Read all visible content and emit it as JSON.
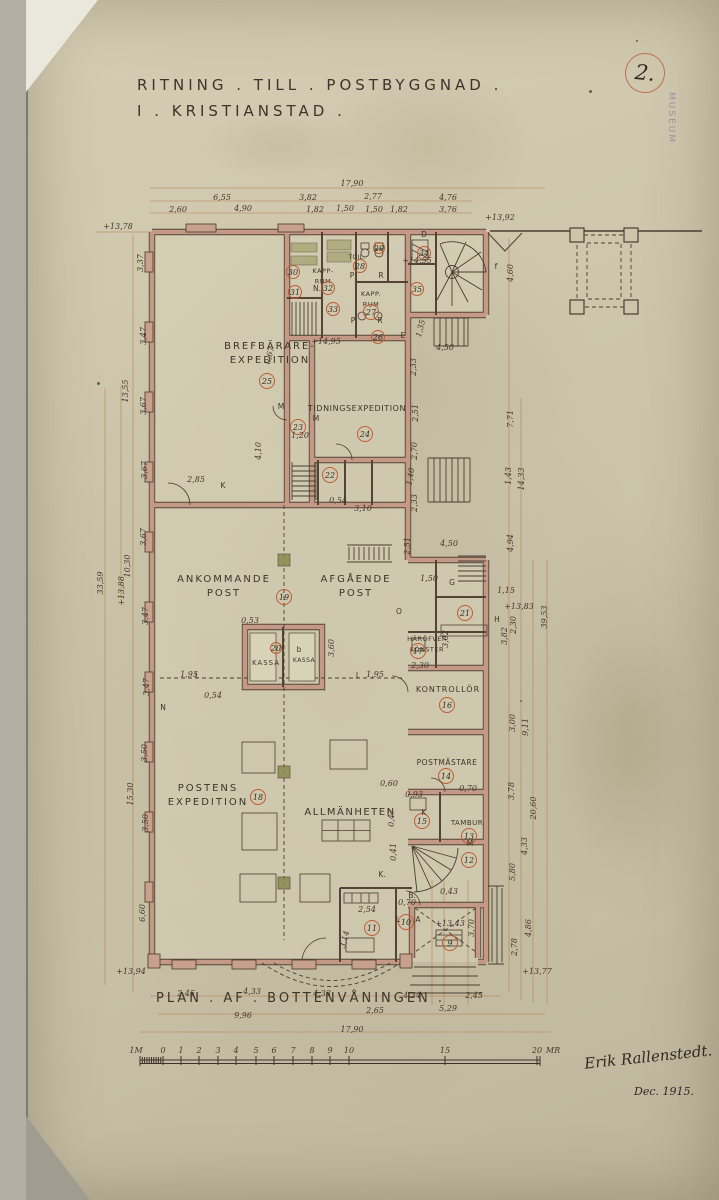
{
  "sheet": {
    "number": "2.",
    "stamp": "MUSEUM",
    "title_line1": "RITNING . TILL . POSTBYGGNAD .",
    "title_line2": "I . KRISTIANSTAD .",
    "caption": "PLAN . AF . BOTTENVÅNINGEN .",
    "signature": "Erik Rallenstedt.",
    "date": "Dec. 1915."
  },
  "colors": {
    "paper": "#ccc5ab",
    "ink": "#46362a",
    "wall_fill": "#c49a87",
    "wall_edge": "#544437",
    "dimension_line": "#b4703d",
    "number_circle": "#bf5b33",
    "column_green": "#8a8a50",
    "stamp_purple": "#8b7fa6"
  },
  "room_labels": [
    {
      "lines": [
        "BREFBÄRARE-",
        "EXPEDITION"
      ],
      "x": 270,
      "y": 349,
      "s": 10,
      "ls": 2
    },
    {
      "lines": [
        "TIDNINGSEXPEDITION"
      ],
      "x": 357,
      "y": 411,
      "s": 8,
      "ls": 0.6
    },
    {
      "lines": [
        "ANKOMMANDE",
        "POST"
      ],
      "x": 224,
      "y": 582,
      "s": 10,
      "ls": 2
    },
    {
      "lines": [
        "AFGÅENDE",
        "POST"
      ],
      "x": 356,
      "y": 582,
      "s": 10,
      "ls": 2
    },
    {
      "lines": [
        "KASSA"
      ],
      "x": 266,
      "y": 665,
      "s": 7,
      "ls": 1
    },
    {
      "lines": [
        "KASSA"
      ],
      "x": 304,
      "y": 662,
      "s": 6,
      "ls": 0.5
    },
    {
      "lines": [
        "HÄRÖFVER",
        "FÖNSTER"
      ],
      "x": 427,
      "y": 641,
      "s": 6.5,
      "ls": 0.5
    },
    {
      "lines": [
        "KONTROLLÖR"
      ],
      "x": 448,
      "y": 692,
      "s": 8,
      "ls": 1
    },
    {
      "lines": [
        "POSTMÄSTARE"
      ],
      "x": 447,
      "y": 765,
      "s": 7.5,
      "ls": 0.5
    },
    {
      "lines": [
        "POSTENS",
        "EXPEDITION"
      ],
      "x": 208,
      "y": 791,
      "s": 10,
      "ls": 2
    },
    {
      "lines": [
        "ALLMÄNHETEN"
      ],
      "x": 350,
      "y": 815,
      "s": 10,
      "ls": 1.5
    },
    {
      "lines": [
        "TAMBUR"
      ],
      "x": 467,
      "y": 825,
      "s": 7,
      "ls": 0.5
    },
    {
      "lines": [
        "KAPP-",
        "RUM"
      ],
      "x": 323,
      "y": 273,
      "s": 6.5,
      "ls": 0.5
    },
    {
      "lines": [
        "KAPP.",
        "RUM"
      ],
      "x": 371,
      "y": 296,
      "s": 6.5,
      "ls": 0.5
    },
    {
      "lines": [
        "TOIL."
      ],
      "x": 357,
      "y": 259,
      "s": 6,
      "ls": 0.3
    }
  ],
  "room_numbers": [
    {
      "n": "9",
      "x": 450,
      "y": 943
    },
    {
      "n": "10",
      "x": 406,
      "y": 922
    },
    {
      "n": "11",
      "x": 372,
      "y": 928
    },
    {
      "n": "12",
      "x": 469,
      "y": 860
    },
    {
      "n": "13",
      "x": 469,
      "y": 836
    },
    {
      "n": "14",
      "x": 446,
      "y": 776
    },
    {
      "n": "15",
      "x": 422,
      "y": 821
    },
    {
      "n": "16",
      "x": 447,
      "y": 705
    },
    {
      "n": "17",
      "x": 418,
      "y": 651
    },
    {
      "n": "18",
      "x": 258,
      "y": 797
    },
    {
      "n": "19",
      "x": 284,
      "y": 597
    },
    {
      "n": "20",
      "x": 276,
      "y": 648,
      "r": 5.5
    },
    {
      "n": "21",
      "x": 465,
      "y": 613
    },
    {
      "n": "22",
      "x": 330,
      "y": 475
    },
    {
      "n": "23",
      "x": 298,
      "y": 427
    },
    {
      "n": "24",
      "x": 365,
      "y": 434
    },
    {
      "n": "25",
      "x": 267,
      "y": 381
    },
    {
      "n": "26",
      "x": 378,
      "y": 337,
      "r": 6.5
    },
    {
      "n": "27",
      "x": 371,
      "y": 312
    },
    {
      "n": "28",
      "x": 360,
      "y": 266,
      "r": 6.5
    },
    {
      "n": "29",
      "x": 379,
      "y": 248,
      "r": 5.5
    },
    {
      "n": "30",
      "x": 293,
      "y": 272,
      "r": 6.5
    },
    {
      "n": "31",
      "x": 295,
      "y": 292,
      "r": 6.5
    },
    {
      "n": "32",
      "x": 328,
      "y": 288,
      "r": 6.5
    },
    {
      "n": "33",
      "x": 333,
      "y": 309,
      "r": 6.5
    },
    {
      "n": "34",
      "x": 424,
      "y": 253,
      "r": 6.5
    },
    {
      "n": "35",
      "x": 417,
      "y": 289,
      "r": 6.5
    }
  ],
  "dimensions": [
    {
      "t": "17,90",
      "x": 352,
      "y": 186,
      "s": 10
    },
    {
      "t": "6,55",
      "x": 222,
      "y": 200
    },
    {
      "t": "3,82",
      "x": 308,
      "y": 200
    },
    {
      "t": "2,77",
      "x": 373,
      "y": 199
    },
    {
      "t": "4,76",
      "x": 448,
      "y": 200
    },
    {
      "t": "2,60",
      "x": 178,
      "y": 212
    },
    {
      "t": "4,90",
      "x": 243,
      "y": 211
    },
    {
      "t": "1,82",
      "x": 315,
      "y": 212
    },
    {
      "t": "1,50",
      "x": 345,
      "y": 211
    },
    {
      "t": "1,50",
      "x": 374,
      "y": 212
    },
    {
      "t": "1,82",
      "x": 399,
      "y": 212
    },
    {
      "t": "3,76",
      "x": 448,
      "y": 212
    },
    {
      "t": "+13,78",
      "x": 118,
      "y": 229
    },
    {
      "t": "+13,92",
      "x": 500,
      "y": 220
    },
    {
      "t": "4,60",
      "x": 513,
      "y": 273,
      "r": -90
    },
    {
      "t": "+14,55",
      "x": 417,
      "y": 263,
      "s": 6.5
    },
    {
      "t": "4,50",
      "x": 445,
      "y": 350
    },
    {
      "t": "1,35",
      "x": 423,
      "y": 329,
      "r": -75,
      "s": 7
    },
    {
      "t": "2,33",
      "x": 416,
      "y": 367,
      "r": -90,
      "s": 7.5
    },
    {
      "t": "+14,95",
      "x": 326,
      "y": 344,
      "s": 7.5
    },
    {
      "t": "0,67",
      "x": 272,
      "y": 356,
      "r": -75,
      "s": 7
    },
    {
      "t": "1,20",
      "x": 300,
      "y": 438,
      "s": 7
    },
    {
      "t": "4,10",
      "x": 261,
      "y": 451,
      "r": -90
    },
    {
      "t": "2,85",
      "x": 196,
      "y": 482
    },
    {
      "t": "0,54",
      "x": 338,
      "y": 503,
      "s": 7
    },
    {
      "t": "3,10",
      "x": 363,
      "y": 511
    },
    {
      "t": "3,37",
      "x": 143,
      "y": 263,
      "r": -90
    },
    {
      "t": "3,47",
      "x": 146,
      "y": 336,
      "r": -90
    },
    {
      "t": "13,55",
      "x": 128,
      "y": 391,
      "r": -90
    },
    {
      "t": "3,67",
      "x": 146,
      "y": 406,
      "r": -90
    },
    {
      "t": "3,67",
      "x": 147,
      "y": 470,
      "r": -90
    },
    {
      "t": "3,67",
      "x": 146,
      "y": 537,
      "r": -90
    },
    {
      "t": "10,30",
      "x": 130,
      "y": 566,
      "r": -90
    },
    {
      "t": "+13,88",
      "x": 124,
      "y": 591,
      "r": -90,
      "s": 7.5
    },
    {
      "t": "33,59",
      "x": 103,
      "y": 583,
      "r": -90,
      "s": 10
    },
    {
      "t": "3,47",
      "x": 148,
      "y": 616,
      "r": -90
    },
    {
      "t": "3,47",
      "x": 149,
      "y": 687,
      "r": -90
    },
    {
      "t": "3,50",
      "x": 147,
      "y": 753,
      "r": -90
    },
    {
      "t": "15,30",
      "x": 133,
      "y": 794,
      "r": -90
    },
    {
      "t": "3,50",
      "x": 148,
      "y": 823,
      "r": -90
    },
    {
      "t": "6,60",
      "x": 145,
      "y": 913,
      "r": -90
    },
    {
      "t": "+13,94",
      "x": 131,
      "y": 974
    },
    {
      "t": "0,53",
      "x": 250,
      "y": 623,
      "s": 7
    },
    {
      "t": "3,60",
      "x": 334,
      "y": 648,
      "r": -90
    },
    {
      "t": "1,95",
      "x": 189,
      "y": 677
    },
    {
      "t": "0,54",
      "x": 213,
      "y": 698,
      "s": 7
    },
    {
      "t": "1,95",
      "x": 375,
      "y": 677
    },
    {
      "t": "2,51",
      "x": 418,
      "y": 413,
      "r": -90,
      "s": 7.5
    },
    {
      "t": "2,70",
      "x": 417,
      "y": 451,
      "r": -90,
      "s": 7.5
    },
    {
      "t": "1,40",
      "x": 413,
      "y": 477,
      "r": -80,
      "s": 7
    },
    {
      "t": "2,33",
      "x": 417,
      "y": 503,
      "r": -90,
      "s": 7.5
    },
    {
      "t": "2,51",
      "x": 410,
      "y": 546,
      "r": -90,
      "s": 7.5
    },
    {
      "t": "4,50",
      "x": 449,
      "y": 546
    },
    {
      "t": "1,50",
      "x": 429,
      "y": 581,
      "s": 7
    },
    {
      "t": "7,71",
      "x": 513,
      "y": 419,
      "r": -90
    },
    {
      "t": "1,43",
      "x": 511,
      "y": 476,
      "r": -90,
      "s": 7.5
    },
    {
      "t": "14,33",
      "x": 524,
      "y": 479,
      "r": -90
    },
    {
      "t": "4,94",
      "x": 513,
      "y": 543,
      "r": -90
    },
    {
      "t": "1,15",
      "x": 506,
      "y": 593,
      "s": 7
    },
    {
      "t": "+13,83",
      "x": 519,
      "y": 609,
      "s": 7
    },
    {
      "t": "2,30",
      "x": 516,
      "y": 625,
      "r": -90,
      "s": 7.5
    },
    {
      "t": "3,82",
      "x": 507,
      "y": 636,
      "r": -90,
      "s": 7.5
    },
    {
      "t": "39,53",
      "x": 547,
      "y": 617,
      "r": -90,
      "s": 11
    },
    {
      "t": "3,00",
      "x": 515,
      "y": 723,
      "r": -90
    },
    {
      "t": "9,11",
      "x": 528,
      "y": 727,
      "r": -90
    },
    {
      "t": "3,78",
      "x": 514,
      "y": 791,
      "r": -90
    },
    {
      "t": "20,60",
      "x": 536,
      "y": 808,
      "r": -90,
      "s": 9
    },
    {
      "t": "4,33",
      "x": 527,
      "y": 846,
      "r": -90
    },
    {
      "t": "5,80",
      "x": 515,
      "y": 872,
      "r": -90
    },
    {
      "t": "4,86",
      "x": 531,
      "y": 928,
      "r": -90
    },
    {
      "t": "2,78",
      "x": 517,
      "y": 947,
      "r": -90
    },
    {
      "t": "+13,77",
      "x": 537,
      "y": 974
    },
    {
      "t": "3,02",
      "x": 448,
      "y": 639,
      "r": -90,
      "s": 7
    },
    {
      "t": "2,30",
      "x": 420,
      "y": 668,
      "s": 7
    },
    {
      "t": "0,93",
      "x": 414,
      "y": 797,
      "s": 6.5
    },
    {
      "t": "0,70",
      "x": 468,
      "y": 791,
      "s": 6.5
    },
    {
      "t": "0,60",
      "x": 389,
      "y": 786,
      "s": 6.5
    },
    {
      "t": "0,47",
      "x": 394,
      "y": 818,
      "r": -90,
      "s": 6.5
    },
    {
      "t": "0,41",
      "x": 396,
      "y": 852,
      "r": -90,
      "s": 6.5
    },
    {
      "t": "0,43",
      "x": 449,
      "y": 894,
      "s": 6.5
    },
    {
      "t": "0,70",
      "x": 407,
      "y": 905,
      "s": 6.5
    },
    {
      "t": "2,54",
      "x": 367,
      "y": 912,
      "s": 7
    },
    {
      "t": "3,14",
      "x": 347,
      "y": 940,
      "r": -75,
      "s": 7
    },
    {
      "t": "+13,43",
      "x": 450,
      "y": 926,
      "s": 6.5
    },
    {
      "t": "3,70",
      "x": 474,
      "y": 928,
      "r": -90,
      "s": 7
    },
    {
      "t": "2,45",
      "x": 186,
      "y": 996
    },
    {
      "t": "4,33",
      "x": 252,
      "y": 994
    },
    {
      "t": "4,33",
      "x": 322,
      "y": 996
    },
    {
      "t": "4,34",
      "x": 412,
      "y": 998
    },
    {
      "t": "2,45",
      "x": 474,
      "y": 998
    },
    {
      "t": "9,96",
      "x": 243,
      "y": 1018
    },
    {
      "t": "2,65",
      "x": 375,
      "y": 1013
    },
    {
      "t": "5,29",
      "x": 448,
      "y": 1011
    },
    {
      "t": "17,90",
      "x": 352,
      "y": 1032,
      "s": 10
    }
  ],
  "letters": [
    {
      "t": "D",
      "x": 424,
      "y": 237
    },
    {
      "t": "E",
      "x": 403,
      "y": 338
    },
    {
      "t": "f",
      "x": 496,
      "y": 269
    },
    {
      "t": "G",
      "x": 452,
      "y": 585
    },
    {
      "t": "H",
      "x": 497,
      "y": 622
    },
    {
      "t": "O",
      "x": 399,
      "y": 614
    },
    {
      "t": "K",
      "x": 223,
      "y": 488
    },
    {
      "t": "K",
      "x": 424,
      "y": 815
    },
    {
      "t": "K.",
      "x": 382,
      "y": 877
    },
    {
      "t": "L",
      "x": 197,
      "y": 678
    },
    {
      "t": "L",
      "x": 358,
      "y": 678
    },
    {
      "t": "L",
      "x": 398,
      "y": 922
    },
    {
      "t": "A",
      "x": 418,
      "y": 922
    },
    {
      "t": "M",
      "x": 281,
      "y": 409
    },
    {
      "t": "M",
      "x": 316,
      "y": 421
    },
    {
      "t": "M",
      "x": 470,
      "y": 846
    },
    {
      "t": "N",
      "x": 163,
      "y": 710
    },
    {
      "t": "P",
      "x": 352,
      "y": 278
    },
    {
      "t": "R",
      "x": 381,
      "y": 278
    },
    {
      "t": "P",
      "x": 353,
      "y": 323
    },
    {
      "t": "R",
      "x": 380,
      "y": 323
    },
    {
      "t": "N.",
      "x": 317,
      "y": 291,
      "s": 6
    },
    {
      "t": "b",
      "x": 299,
      "y": 652,
      "s": 6
    },
    {
      "t": "B.",
      "x": 412,
      "y": 898,
      "s": 6
    }
  ],
  "scalebar": {
    "unit_left": "1M",
    "unit_right": "MR",
    "ticks": [
      {
        "t": "1M",
        "x": 136
      },
      {
        "t": "0",
        "x": 163
      },
      {
        "t": "1",
        "x": 181
      },
      {
        "t": "2",
        "x": 199
      },
      {
        "t": "3",
        "x": 218
      },
      {
        "t": "4",
        "x": 236
      },
      {
        "t": "5",
        "x": 256
      },
      {
        "t": "6",
        "x": 274
      },
      {
        "t": "7",
        "x": 293
      },
      {
        "t": "8",
        "x": 312
      },
      {
        "t": "9",
        "x": 330
      },
      {
        "t": "10",
        "x": 349
      },
      {
        "t": "15",
        "x": 445
      },
      {
        "t": "20",
        "x": 537
      },
      {
        "t": "MR",
        "x": 553
      }
    ]
  }
}
